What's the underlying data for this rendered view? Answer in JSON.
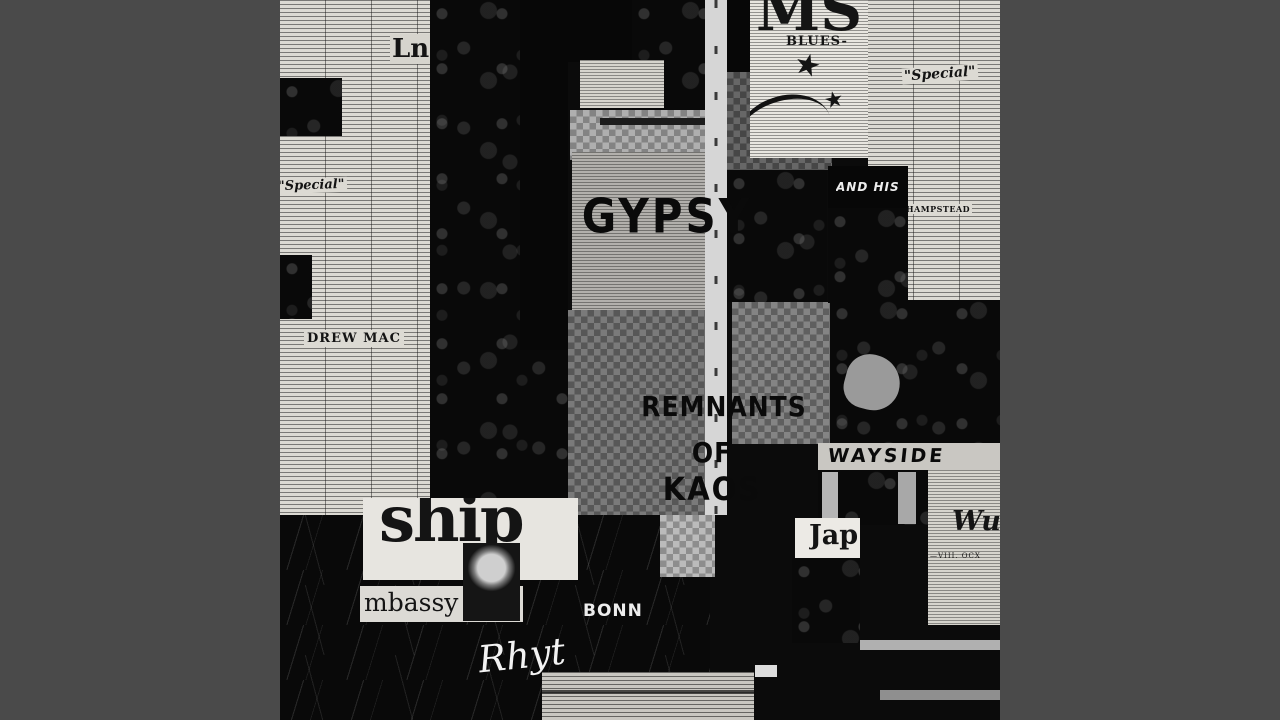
{
  "canvas": {
    "background": "#4a4a4a",
    "art_background": "#0b0b0b",
    "paper_color": "#dcdad3",
    "ink_color": "#111111"
  },
  "art": {
    "kind": "album-cover-newspaper-collage",
    "title": "GYPSY",
    "subtitle_lines": [
      "REMNANTS",
      "OF",
      "KAOS"
    ],
    "fragments": {
      "ship": "ship",
      "embassy": "mbassy Sta",
      "bonn": "BONN",
      "rhythm": "Rhyt",
      "japan": "Jap",
      "ms": "MS",
      "blues": "BLUES-",
      "and_his": "AND HIS",
      "wayside": "WAYSIDE",
      "special_left": "\"Special\"",
      "special_right": "\"Special\"",
      "hampstead": "HAMPSTEAD",
      "drew_mac": "DREW MAC",
      "wu": "Wu",
      "viii": "—VIII.  OCX",
      "ln": "Ln",
      "star": "★"
    }
  }
}
